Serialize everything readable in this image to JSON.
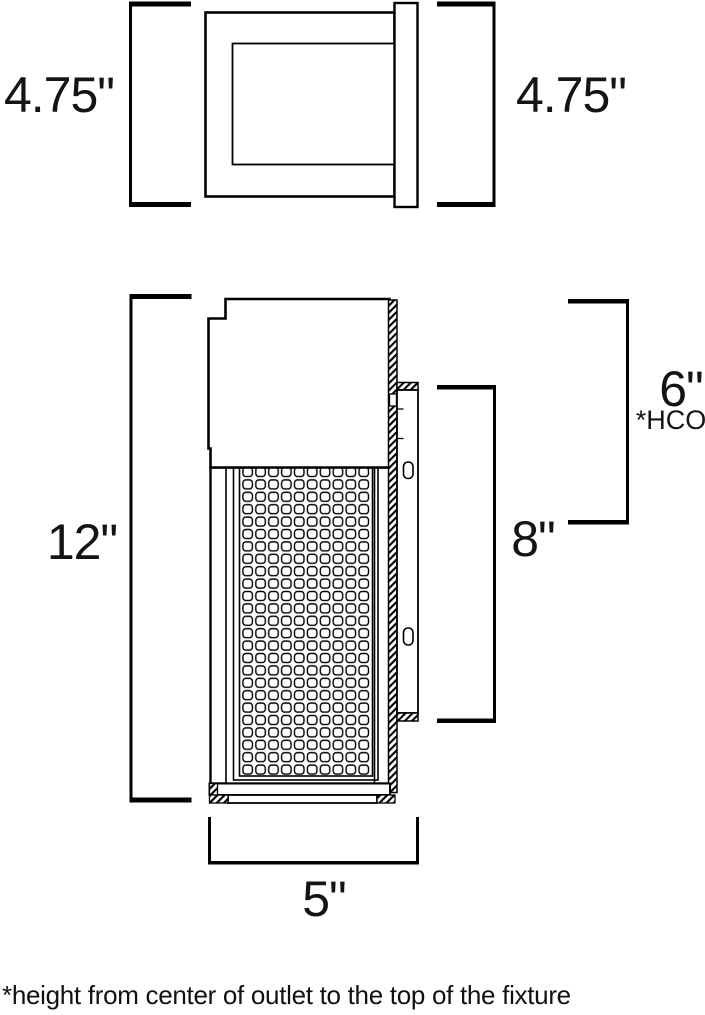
{
  "labels": {
    "top_view_left": "4.75\"",
    "top_view_right": "4.75\"",
    "fixture_height": "12\"",
    "backplate_height": "8\"",
    "height_center_outlet": "6\"",
    "hco_abbrev": "*HCO",
    "fixture_width": "5\"",
    "footnote": "*height from center of outlet to the top of the fixture"
  },
  "colors": {
    "line": "#000000",
    "background": "#ffffff",
    "text": "#141414"
  }
}
